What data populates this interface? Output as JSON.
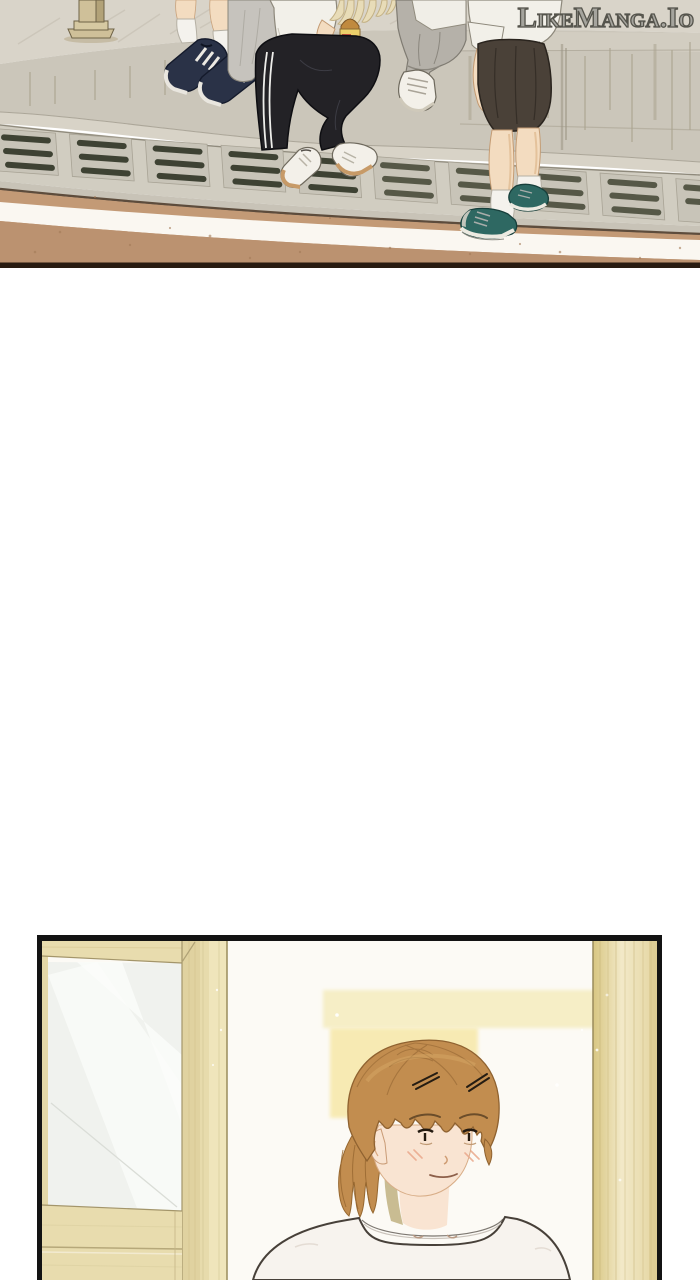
{
  "watermark": {
    "text": "LikeManga.Io"
  },
  "page": {
    "width": 700,
    "height": 1280,
    "background": "#ffffff"
  },
  "panels": [
    {
      "id": "panel-1",
      "alt": "Platform ledge scene: four students' legs and shoes above a drain grate and tan ground with white stripe"
    },
    {
      "id": "panel-2",
      "alt": "Interior doorway scene: girl with auburn ponytail and white t-shirt beside wooden door and pillar"
    }
  ],
  "colors": {
    "page_bg": "#ffffff",
    "watermark_fill": "rgba(240,238,232,0.52)",
    "watermark_stroke": "#55544c",
    "concrete_surface": "#d9d4c9",
    "concrete_face": "#cbc6ba",
    "concrete_curb": "#d8d3c7",
    "grate_frame": "#d1cdc1",
    "grate_panel": "#c8c4b8",
    "grate_slot": "#3e4233",
    "grate_slot_light": "#565847",
    "concrete_lip": "#c8c3b7",
    "ground_line": "#5d4c3c",
    "ground_tan": "#c39a76",
    "ground_tan_dark": "#bb9270",
    "stripe_white": "#faf7f1",
    "panel_border": "#281b11",
    "post_beige": "#cfc099",
    "post_beige_dark": "#b2a278",
    "navy_shoe": "#2a3247",
    "white_fabric": "#f2f0e9",
    "gray_pants": "#b5b1a9",
    "track_pants": "#232226",
    "skin": "#f3dcc0",
    "teal_shoe": "#2e6862",
    "skirt_brown": "#4a4138",
    "white_shoe": "#f3f0e9",
    "wall_white": "#fcfaf5",
    "wood_light": "#e8dcae",
    "glass_base": "#f0f2ee",
    "light_yellow_band": "#f6eec6",
    "light_yellow_block": "#f7eab0",
    "hair_base": "#c28d4f",
    "skin_face": "#f9e4d2",
    "neck_shadow_olive": "#c9bc92",
    "shirt_white": "#f7f3ee",
    "panel2_border": "#131313",
    "pillar_gold_1": "#d8c682",
    "pillar_gold_2": "#f2e9c8",
    "pillar_gold_3": "#e4d5a0"
  }
}
